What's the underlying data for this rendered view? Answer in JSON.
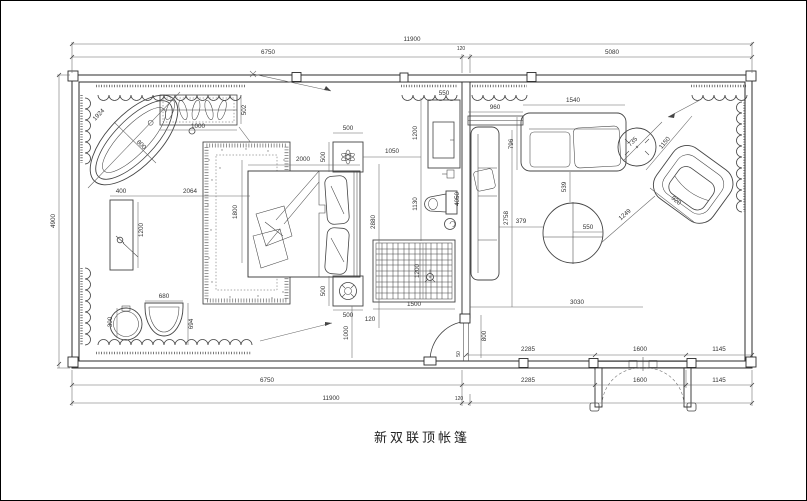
{
  "page": {
    "title": "新双联顶帐篷",
    "background": "#ffffff",
    "line_color": "#444444"
  },
  "dimensions": {
    "top": {
      "total": "11900",
      "left_section": "6750",
      "wall": "120",
      "right_section": "5080"
    },
    "left": {
      "height": "4900"
    },
    "bottom": {
      "row_inner": {
        "a": "2285",
        "b": "1600",
        "c": "1145"
      },
      "row_mid": {
        "left": "6750",
        "a": "2285",
        "b": "1600",
        "c": "1145"
      },
      "row_total": {
        "total": "11900",
        "wall": "120"
      }
    },
    "bathroom": {
      "tub_length": "1924",
      "tub_width": "800",
      "planter_width": "1000",
      "planter_depth": "502",
      "vanity_width": "400",
      "vanity_to_bed": "2064",
      "vanity_length": "1200",
      "basin": "300",
      "sink_width": "680",
      "sink_depth": "694"
    },
    "bedroom": {
      "carpet_length": "1800",
      "bed_width": "2000",
      "nightstand_top_w": "500",
      "nightstand_top_d": "500",
      "nightstand_bottom_d": "500",
      "nightstand_bottom_w": "500",
      "bed_to_wall": "1050",
      "bed_axis": "2880",
      "nightstand_offset": "120",
      "nightstand_to_wall": "1000",
      "rug_width": "1500",
      "rug_depth": "1200"
    },
    "partition": {
      "cabinet_width": "550",
      "cabinet_length": "1200",
      "toilet_zone": "1130",
      "wall_length": "4050",
      "door_width": "800",
      "door_offset": "50"
    },
    "living": {
      "console": "960",
      "sofa_width": "1540",
      "sofa_depth": "796",
      "depth": "2758",
      "sofa_to_table": "539",
      "sofa_side_to_table": "379",
      "table_diameter": "550",
      "width": "3030",
      "side_table": "735",
      "chair_length": "1150",
      "chair_depth": "920",
      "table_to_chair": "1249"
    }
  }
}
